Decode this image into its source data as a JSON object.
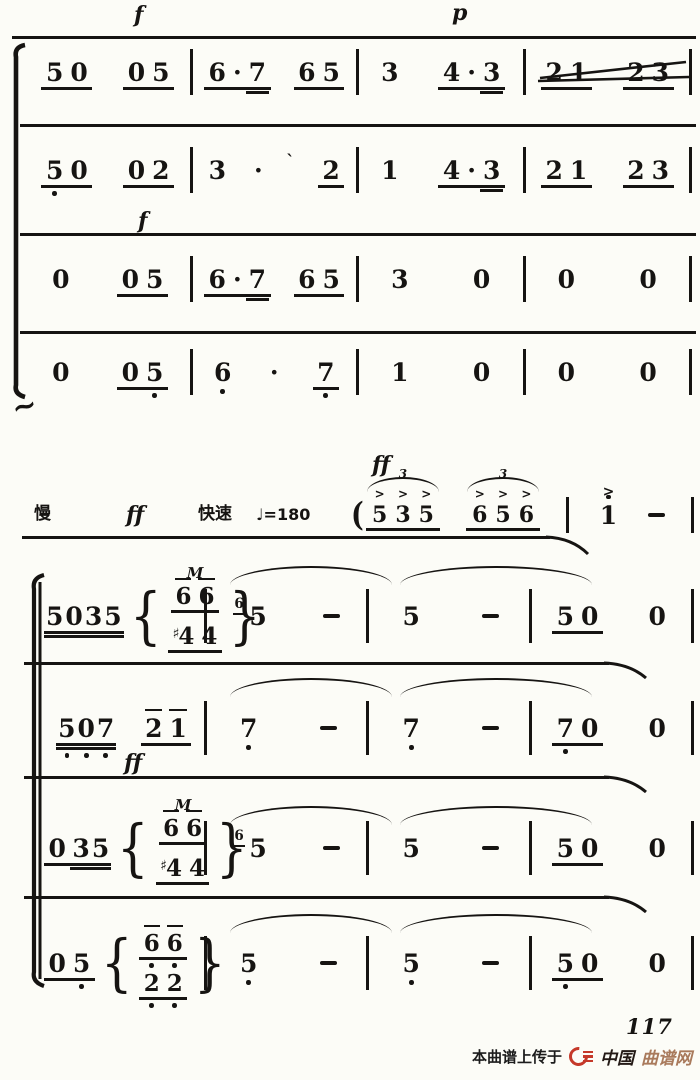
{
  "page": {
    "background": "#fcfcf7",
    "ink": "#161412",
    "accent_red": "#c5392a",
    "brand_tan": "#a97a5c"
  },
  "annotations": [
    {
      "name": "dynamic-f-staff1",
      "text": "f",
      "x": 134,
      "y": 4,
      "cls": "dyn"
    },
    {
      "name": "dynamic-p-staff1",
      "text": "p",
      "x": 452,
      "y": 2,
      "cls": "dyn"
    },
    {
      "name": "dynamic-f-staff3",
      "text": "f",
      "x": 138,
      "y": 210,
      "cls": "dyn"
    },
    {
      "name": "dynamic-ff-pickup",
      "text": "ff",
      "x": 372,
      "y": 454,
      "cls": "dyn"
    },
    {
      "name": "tempo-slow-label",
      "text": "慢",
      "x": 34,
      "y": 506,
      "cls": "cn"
    },
    {
      "name": "dynamic-ff-tempo",
      "text": "ff",
      "x": 126,
      "y": 504,
      "cls": "dyn"
    },
    {
      "name": "tempo-fast-label",
      "text": "快速",
      "x": 198,
      "y": 506,
      "cls": "cn"
    },
    {
      "name": "metronome-marking",
      "text": "♩=180",
      "x": 256,
      "y": 507,
      "cls": "metro"
    },
    {
      "name": "dynamic-ff-staff7",
      "text": "ff",
      "x": 124,
      "y": 752,
      "cls": "dyn"
    },
    {
      "name": "squiggle-mark",
      "text": "~",
      "x": 12,
      "y": 392,
      "cls": "sq"
    }
  ],
  "pickup": {
    "cells": [
      {
        "t": "trip",
        "c": [
          "5",
          "3",
          "5"
        ],
        "num": "3",
        "acc": ">",
        "paren": "("
      },
      {
        "t": "trip",
        "c": [
          "6",
          "5",
          "6"
        ],
        "num": "3",
        "acc": ">"
      },
      {
        "t": "bar"
      },
      {
        "t": "g",
        "c": [
          "1'"
        ],
        "u": 0,
        "acc": ">"
      },
      {
        "t": "dash"
      },
      {
        "t": "bar"
      }
    ]
  },
  "staves_top": [
    {
      "measures": [
        [
          {
            "t": "g",
            "c": [
              "5",
              "0"
            ],
            "u": 1
          },
          {
            "t": "g",
            "c": [
              "0",
              "5"
            ],
            "u": 1
          }
        ],
        [
          {
            "t": "g",
            "c": [
              "6",
              "·",
              "7="
            ],
            "u": 1
          },
          {
            "t": "g",
            "c": [
              "6",
              "5"
            ],
            "u": 1
          }
        ],
        [
          {
            "t": "g",
            "c": [
              "3"
            ],
            "u": 0
          },
          {
            "t": "g",
            "c": [
              "4",
              "·",
              "3="
            ],
            "u": 1
          }
        ],
        [
          {
            "t": "g",
            "c": [
              "2",
              "1"
            ],
            "u": 1
          },
          {
            "t": "g",
            "c": [
              "2",
              "3"
            ],
            "u": 1
          }
        ]
      ]
    },
    {
      "measures": [
        [
          {
            "t": "g",
            "c": [
              "5.",
              "0"
            ],
            "u": 1
          },
          {
            "t": "g",
            "c": [
              "0",
              "2"
            ],
            "u": 1
          }
        ],
        [
          {
            "t": "g",
            "c": [
              "3"
            ],
            "u": 0
          },
          {
            "t": "dot"
          },
          {
            "t": "mark",
            "c": "`"
          },
          {
            "t": "g",
            "c": [
              "2"
            ],
            "u": 1
          }
        ],
        [
          {
            "t": "g",
            "c": [
              "1"
            ],
            "u": 0
          },
          {
            "t": "g",
            "c": [
              "4",
              "·",
              "3="
            ],
            "u": 1
          }
        ],
        [
          {
            "t": "g",
            "c": [
              "2",
              "1"
            ],
            "u": 1
          },
          {
            "t": "g",
            "c": [
              "2",
              "3"
            ],
            "u": 1
          }
        ]
      ]
    },
    {
      "measures": [
        [
          {
            "t": "g",
            "c": [
              "0"
            ],
            "u": 0
          },
          {
            "t": "g",
            "c": [
              "0",
              "5"
            ],
            "u": 1
          }
        ],
        [
          {
            "t": "g",
            "c": [
              "6",
              "·",
              "7="
            ],
            "u": 1
          },
          {
            "t": "g",
            "c": [
              "6",
              "5"
            ],
            "u": 1
          }
        ],
        [
          {
            "t": "g",
            "c": [
              "3"
            ],
            "u": 0
          },
          {
            "t": "g",
            "c": [
              "0"
            ],
            "u": 0
          }
        ],
        [
          {
            "t": "g",
            "c": [
              "0"
            ],
            "u": 0
          },
          {
            "t": "g",
            "c": [
              "0"
            ],
            "u": 0
          }
        ]
      ]
    },
    {
      "measures": [
        [
          {
            "t": "g",
            "c": [
              "0"
            ],
            "u": 0
          },
          {
            "t": "g",
            "c": [
              "0",
              "5."
            ],
            "u": 1
          }
        ],
        [
          {
            "t": "g",
            "c": [
              "6."
            ],
            "u": 0
          },
          {
            "t": "dot"
          },
          {
            "t": "g",
            "c": [
              "7."
            ],
            "u": 1
          }
        ],
        [
          {
            "t": "g",
            "c": [
              "1"
            ],
            "u": 0
          },
          {
            "t": "g",
            "c": [
              "0"
            ],
            "u": 0
          }
        ],
        [
          {
            "t": "g",
            "c": [
              "0"
            ],
            "u": 0
          },
          {
            "t": "g",
            "c": [
              "0"
            ],
            "u": 0
          }
        ]
      ]
    }
  ],
  "staves_bottom": [
    {
      "measures": [
        [
          {
            "t": "g",
            "c": [
              "5",
              "0",
              "3",
              "5"
            ],
            "u": 2,
            "tight": true
          },
          {
            "t": "chord",
            "top": {
              "c": [
                "6-",
                "6-"
              ],
              "u": 1
            },
            "bot": {
              "c": [
                "#4",
                "4"
              ],
              "u": 1
            },
            "orn": "M"
          }
        ],
        [
          {
            "t": "g",
            "c": [
              "5"
            ],
            "u": 0,
            "grace": "6"
          },
          {
            "t": "dash"
          }
        ],
        [
          {
            "t": "g",
            "c": [
              "5"
            ],
            "u": 0
          },
          {
            "t": "dash"
          }
        ],
        [
          {
            "t": "g",
            "c": [
              "5",
              "0"
            ],
            "u": 1
          },
          {
            "t": "g",
            "c": [
              "0"
            ],
            "u": 0
          }
        ]
      ]
    },
    {
      "measures": [
        [
          {
            "t": "g",
            "c": [
              "5.",
              "0.",
              "7."
            ],
            "u": 2,
            "tight": true
          },
          {
            "t": "g",
            "c": [
              "2-",
              "1-"
            ],
            "u": 1
          }
        ],
        [
          {
            "t": "g",
            "c": [
              "7."
            ],
            "u": 0
          },
          {
            "t": "dash"
          }
        ],
        [
          {
            "t": "g",
            "c": [
              "7."
            ],
            "u": 0
          },
          {
            "t": "dash"
          }
        ],
        [
          {
            "t": "g",
            "c": [
              "7.",
              "0"
            ],
            "u": 1
          },
          {
            "t": "g",
            "c": [
              "0"
            ],
            "u": 0
          }
        ]
      ]
    },
    {
      "measures": [
        [
          {
            "t": "g",
            "c": [
              "0"
            ],
            "u": 1
          },
          {
            "t": "g",
            "c": [
              "3",
              "5"
            ],
            "u": 2,
            "tight": true
          },
          {
            "t": "chord",
            "top": {
              "c": [
                "6-",
                "6-"
              ],
              "u": 1
            },
            "bot": {
              "c": [
                "#4",
                "4"
              ],
              "u": 1
            },
            "orn": "M"
          }
        ],
        [
          {
            "t": "g",
            "c": [
              "5"
            ],
            "u": 0,
            "grace": "6"
          },
          {
            "t": "dash"
          }
        ],
        [
          {
            "t": "g",
            "c": [
              "5"
            ],
            "u": 0
          },
          {
            "t": "dash"
          }
        ],
        [
          {
            "t": "g",
            "c": [
              "5",
              "0"
            ],
            "u": 1
          },
          {
            "t": "g",
            "c": [
              "0"
            ],
            "u": 0
          }
        ]
      ]
    },
    {
      "measures": [
        [
          {
            "t": "g",
            "c": [
              "0",
              "5."
            ],
            "u": 1
          },
          {
            "t": "chord",
            "top": {
              "c": [
                "6-.",
                "6-."
              ],
              "u": 1
            },
            "bot": {
              "c": [
                "2.",
                "2."
              ],
              "u": 1
            }
          }
        ],
        [
          {
            "t": "g",
            "c": [
              "5."
            ],
            "u": 0
          },
          {
            "t": "dash"
          }
        ],
        [
          {
            "t": "g",
            "c": [
              "5."
            ],
            "u": 0
          },
          {
            "t": "dash"
          }
        ],
        [
          {
            "t": "g",
            "c": [
              "5.",
              "0"
            ],
            "u": 1
          },
          {
            "t": "g",
            "c": [
              "0"
            ],
            "u": 0
          }
        ]
      ]
    }
  ],
  "ties": [
    {
      "x": 230,
      "y": 566,
      "w": 162
    },
    {
      "x": 400,
      "y": 566,
      "w": 192
    },
    {
      "x": 230,
      "y": 678,
      "w": 162
    },
    {
      "x": 400,
      "y": 678,
      "w": 192
    },
    {
      "x": 230,
      "y": 806,
      "w": 162
    },
    {
      "x": 400,
      "y": 806,
      "w": 192
    },
    {
      "x": 230,
      "y": 914,
      "w": 162
    },
    {
      "x": 400,
      "y": 914,
      "w": 192
    }
  ],
  "footer": {
    "page_number": "117",
    "watermark_prefix": "本曲谱上传于",
    "brand_cn": "中国",
    "brand_suffix": "曲谱网"
  }
}
